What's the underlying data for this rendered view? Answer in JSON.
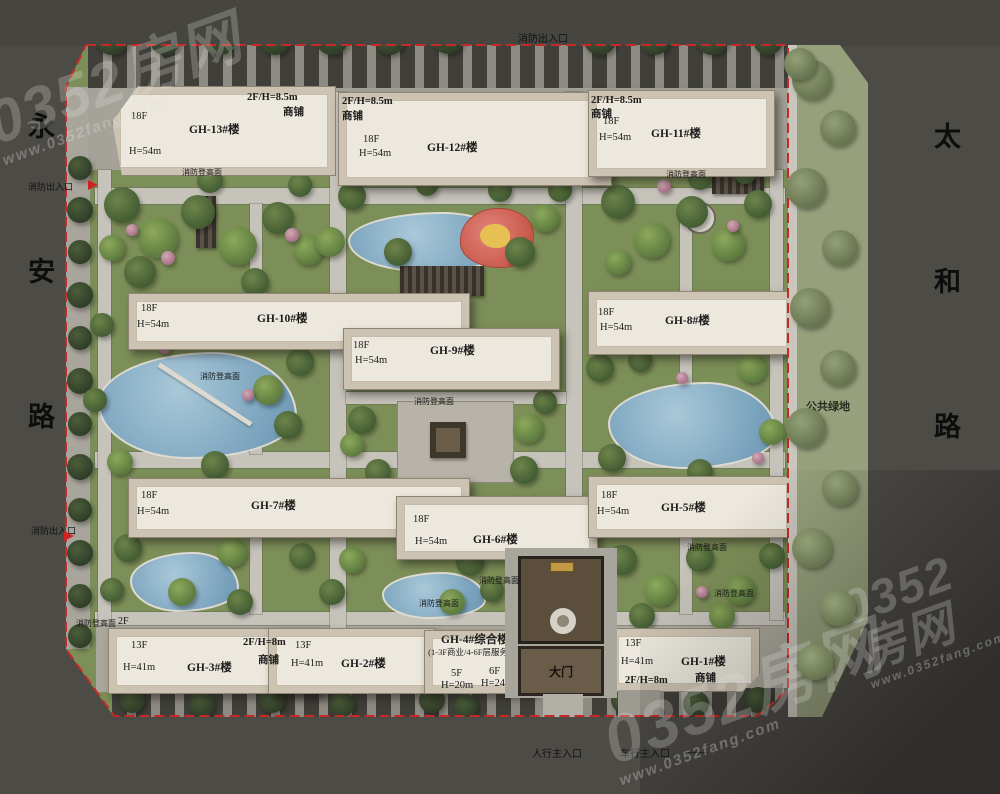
{
  "watermarks": {
    "brand": "0352房网",
    "site": "www.0352fang.com"
  },
  "roads": {
    "west": "永安路",
    "east": "太和路"
  },
  "green": {
    "public": "公共绿地"
  },
  "gate": {
    "label": "大门"
  },
  "entrances": {
    "fire": "消防出入口",
    "pedestrian": "人行主入口",
    "vehicle": "车行主入口"
  },
  "notes": {
    "fire_access": "消防登高面",
    "podium": "2F"
  },
  "buildings": [
    {
      "name": "GH-13#楼",
      "floors": "18F",
      "height": "H=54m",
      "shop_spec": "2F/H=8.5m",
      "shop": "商铺"
    },
    {
      "name": "GH-12#楼",
      "floors": "18F",
      "height": "H=54m",
      "shop_spec": "2F/H=8.5m",
      "shop": "商铺"
    },
    {
      "name": "GH-11#楼",
      "floors": "18F",
      "height": "H=54m",
      "shop_spec": "2F/H=8.5m",
      "shop": "商铺"
    },
    {
      "name": "GH-10#楼",
      "floors": "18F",
      "height": "H=54m"
    },
    {
      "name": "GH-9#楼",
      "floors": "18F",
      "height": "H=54m"
    },
    {
      "name": "GH-8#楼",
      "floors": "18F",
      "height": "H=54m"
    },
    {
      "name": "GH-7#楼",
      "floors": "18F",
      "height": "H=54m"
    },
    {
      "name": "GH-6#楼",
      "floors": "18F",
      "height": "H=54m"
    },
    {
      "name": "GH-5#楼",
      "floors": "18F",
      "height": "H=54m"
    },
    {
      "name": "GH-3#楼",
      "floors": "13F",
      "height": "H=41m"
    },
    {
      "name": "GH-2#楼",
      "floors": "13F",
      "height": "H=41m",
      "shop_spec": "2F/H=8m",
      "shop": "商铺"
    },
    {
      "name": "GH-4#综合楼",
      "sub": "(1-3F商业/4-6F层服务中心)",
      "floors": "5F",
      "height": "H=20m",
      "floors_b": "6F",
      "height_b": "H=24m"
    },
    {
      "name": "GH-1#楼",
      "floors": "13F",
      "height": "H=41m",
      "shop_spec": "2F/H=8m",
      "shop": "商铺"
    }
  ]
}
